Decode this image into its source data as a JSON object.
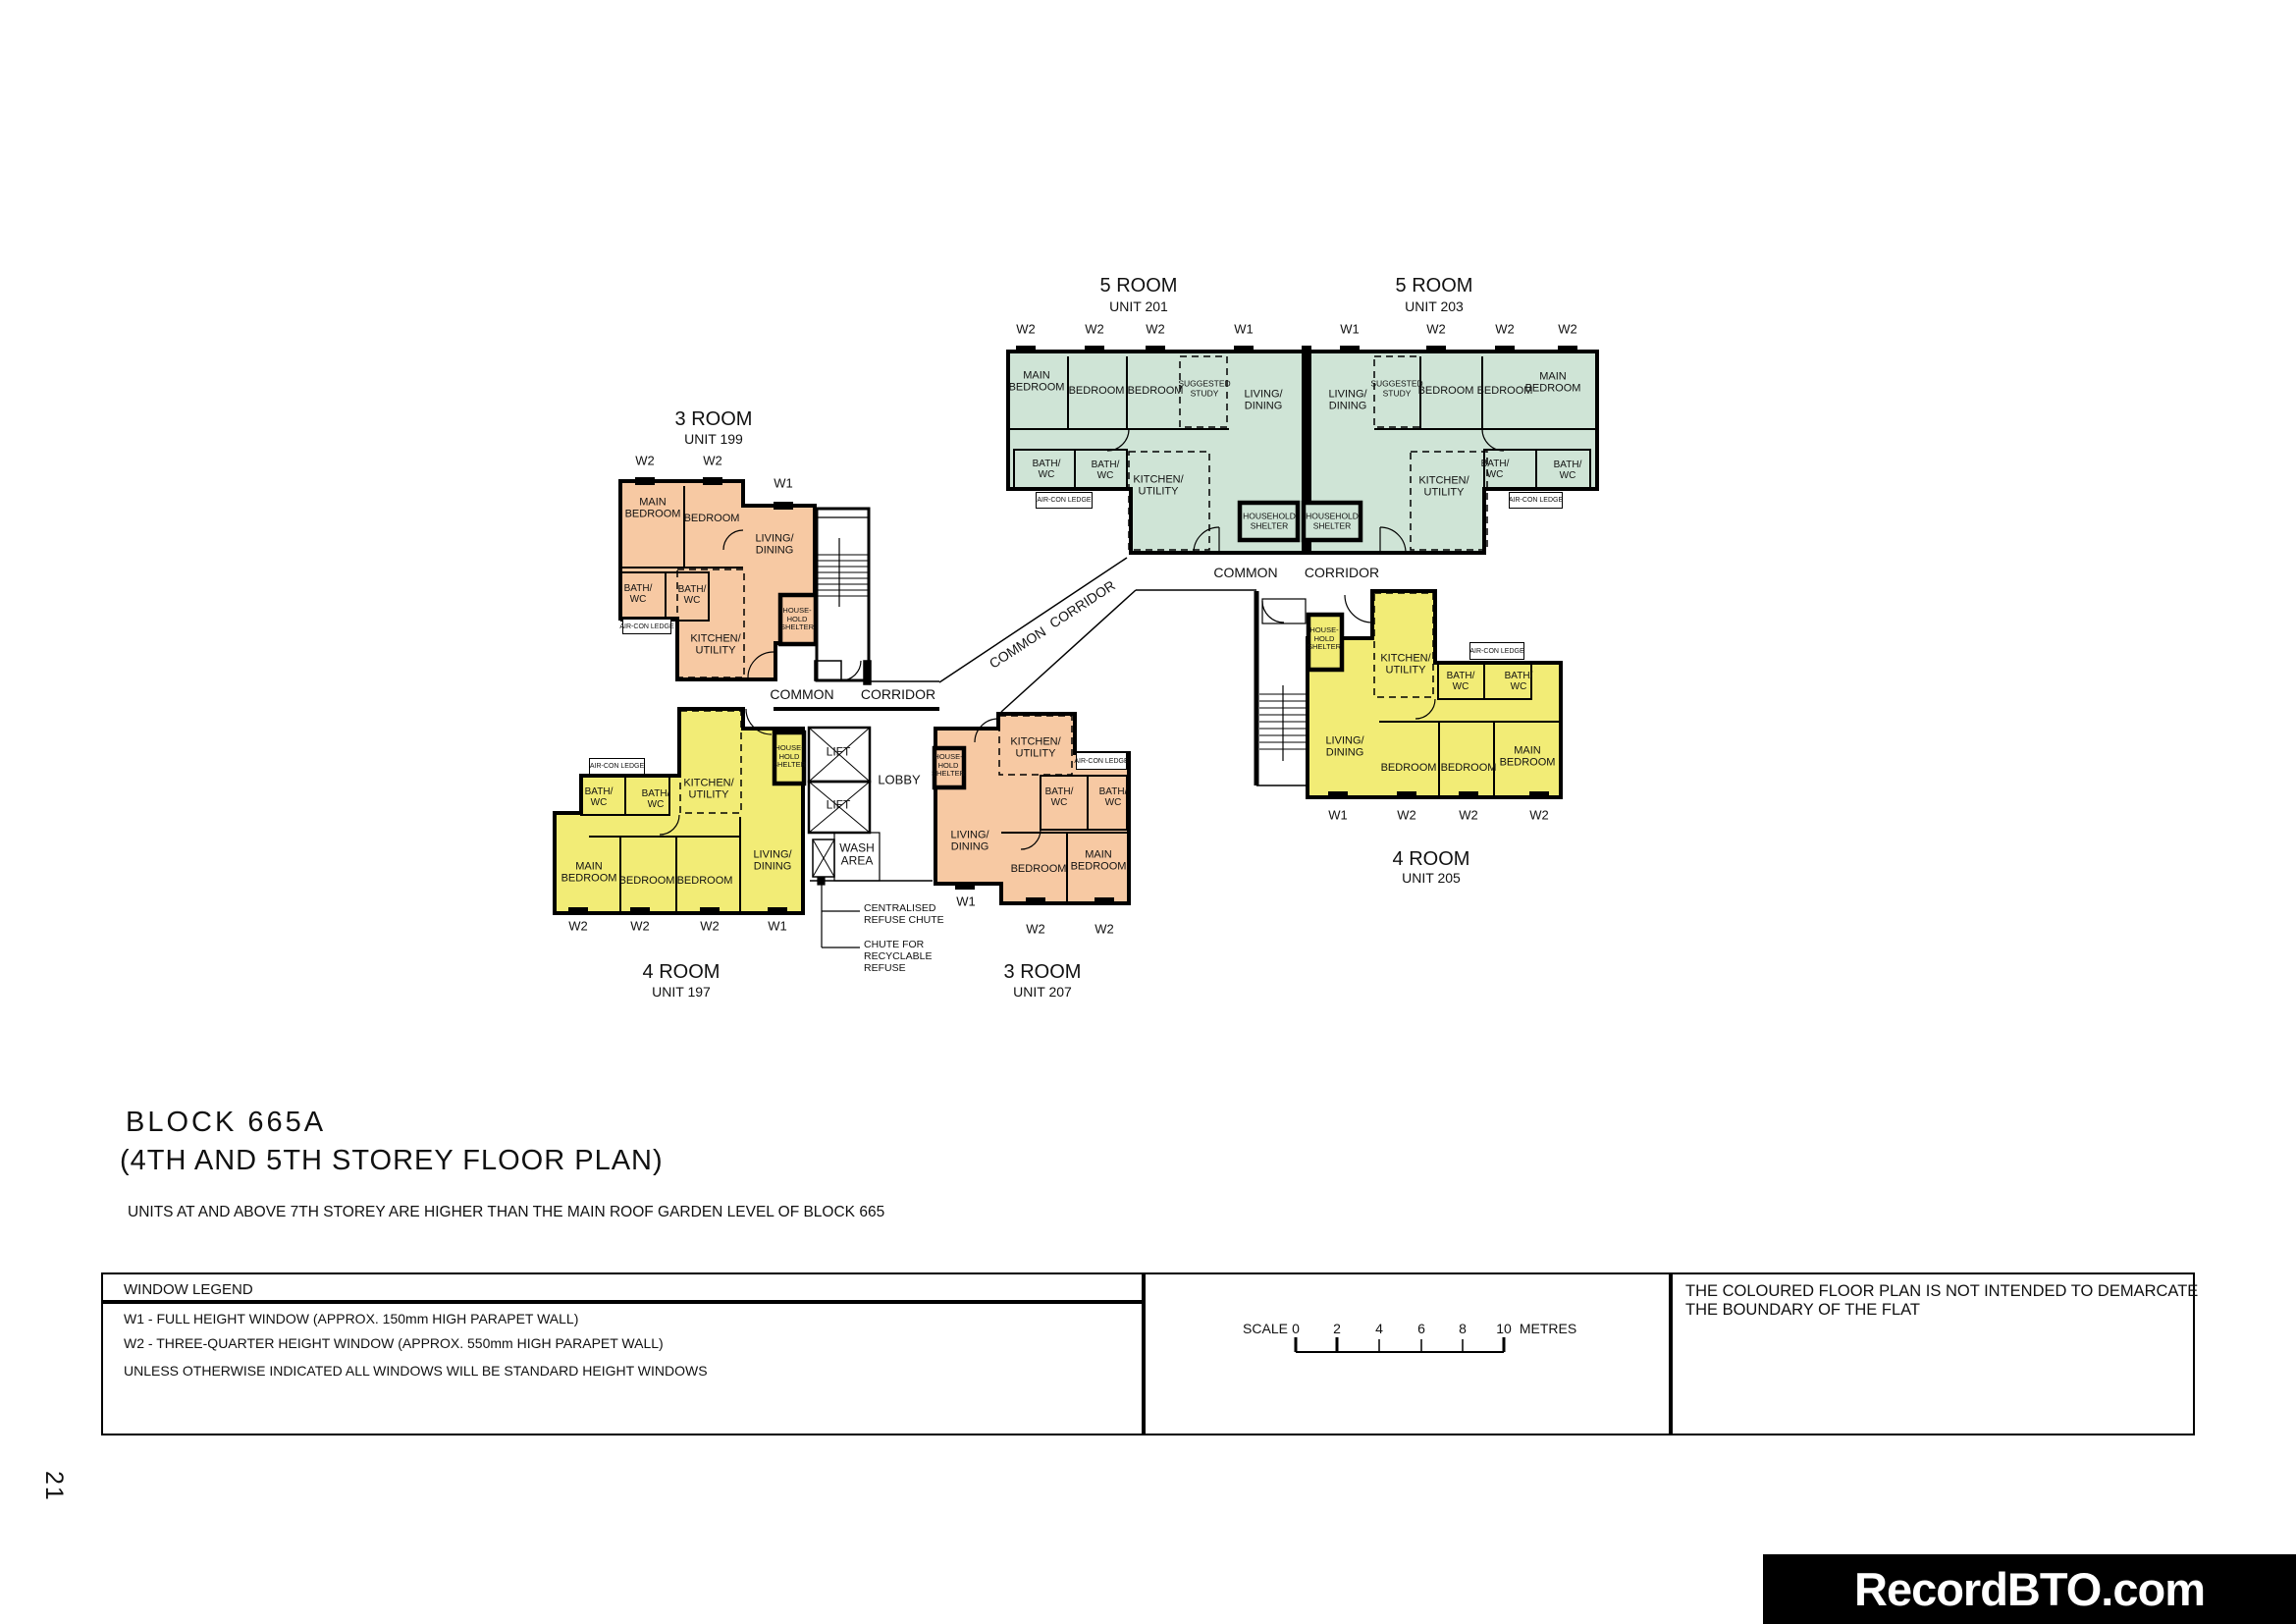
{
  "page": {
    "number": "21",
    "brand": "RecordBTO.com"
  },
  "title_block": {
    "line1": "BLOCK 665A",
    "line2": "(4TH AND 5TH STOREY FLOOR PLAN)",
    "note": "UNITS AT AND ABOVE 7TH STOREY ARE HIGHER THAN THE MAIN ROOF GARDEN LEVEL OF BLOCK 665"
  },
  "window_legend": {
    "header": "WINDOW LEGEND",
    "w1_line": "W1  -  FULL HEIGHT WINDOW (APPROX. 150mm HIGH PARAPET WALL)",
    "w2_line": "W2  -  THREE-QUARTER HEIGHT WINDOW (APPROX. 550mm HIGH PARAPET WALL)",
    "note": "UNLESS OTHERWISE INDICATED ALL WINDOWS WILL BE STANDARD HEIGHT WINDOWS"
  },
  "scale_bar": {
    "label": "SCALE",
    "ticks": [
      "0",
      "2",
      "4",
      "6",
      "8",
      "10"
    ],
    "unit": "METRES"
  },
  "disclaimer": "THE COLOURED FLOOR PLAN IS NOT INTENDED TO DEMARCATE THE BOUNDARY OF THE FLAT",
  "colors": {
    "three_room": "#f7c9a3",
    "four_room": "#f2ec76",
    "five_room": "#cfe4d6",
    "line": "#000000"
  },
  "labels": {
    "main_bedroom": "MAIN\nBEDROOM",
    "bedroom": "BEDROOM",
    "living_dining": "LIVING/\nDINING",
    "kitchen_utility": "KITCHEN/\nUTILITY",
    "bath_wc": "BATH/\nWC",
    "suggested_study": "SUGGESTED\nSTUDY",
    "household_shelter": "HOUSEHOLD\nSHELTER",
    "household_shelter_small": "HOUSE-\nHOLD\nSHELTER",
    "aircon_ledge": "AIR-CON LEDGE",
    "wash_area": "WASH\nAREA",
    "lift": "LIFT",
    "lobby": "LOBBY",
    "common": "COMMON",
    "corridor": "CORRIDOR",
    "w1": "W1",
    "w2": "W2",
    "centralised_refuse": "CENTRALISED\nREFUSE CHUTE",
    "chute_recyclable": "CHUTE FOR\nRECYCLABLE\nREFUSE"
  },
  "units": [
    {
      "type": "4 ROOM",
      "unit_no": "UNIT 197",
      "color": "four_room",
      "windows": [
        "W2",
        "W2",
        "W2",
        "W1"
      ],
      "rooms": [
        "MAIN BEDROOM",
        "BEDROOM",
        "BEDROOM",
        "LIVING/DINING",
        "KITCHEN/UTILITY",
        "BATH/WC",
        "BATH/WC",
        "HOUSEHOLD SHELTER",
        "AIR-CON LEDGE"
      ]
    },
    {
      "type": "3 ROOM",
      "unit_no": "UNIT 199",
      "color": "three_room",
      "windows": [
        "W2",
        "W2",
        "W1"
      ],
      "rooms": [
        "MAIN BEDROOM",
        "BEDROOM",
        "LIVING/DINING",
        "KITCHEN/UTILITY",
        "BATH/WC",
        "BATH/WC",
        "HOUSEHOLD SHELTER",
        "AIR-CON LEDGE"
      ]
    },
    {
      "type": "5 ROOM",
      "unit_no": "UNIT 201",
      "color": "five_room",
      "windows": [
        "W2",
        "W2",
        "W2",
        "W1"
      ],
      "rooms": [
        "MAIN BEDROOM",
        "BEDROOM",
        "BEDROOM",
        "SUGGESTED STUDY",
        "LIVING/DINING",
        "KITCHEN/UTILITY",
        "BATH/WC",
        "BATH/WC",
        "HOUSEHOLD SHELTER",
        "AIR-CON LEDGE"
      ]
    },
    {
      "type": "5 ROOM",
      "unit_no": "UNIT 203",
      "color": "five_room",
      "windows": [
        "W1",
        "W2",
        "W2",
        "W2"
      ],
      "rooms": [
        "MAIN BEDROOM",
        "BEDROOM",
        "BEDROOM",
        "SUGGESTED STUDY",
        "LIVING/DINING",
        "KITCHEN/UTILITY",
        "BATH/WC",
        "BATH/WC",
        "HOUSEHOLD SHELTER",
        "AIR-CON LEDGE"
      ]
    },
    {
      "type": "4 ROOM",
      "unit_no": "UNIT 205",
      "color": "four_room",
      "windows": [
        "W1",
        "W2",
        "W2",
        "W2"
      ],
      "rooms": [
        "MAIN BEDROOM",
        "BEDROOM",
        "BEDROOM",
        "LIVING/DINING",
        "KITCHEN/UTILITY",
        "BATH/WC",
        "BATH/WC",
        "HOUSEHOLD SHELTER",
        "AIR-CON LEDGE"
      ]
    },
    {
      "type": "3 ROOM",
      "unit_no": "UNIT 207",
      "color": "three_room",
      "windows": [
        "W1",
        "W2",
        "W2"
      ],
      "rooms": [
        "MAIN BEDROOM",
        "BEDROOM",
        "LIVING/DINING",
        "KITCHEN/UTILITY",
        "BATH/WC",
        "BATH/WC",
        "HOUSEHOLD SHELTER",
        "AIR-CON LEDGE"
      ]
    }
  ]
}
